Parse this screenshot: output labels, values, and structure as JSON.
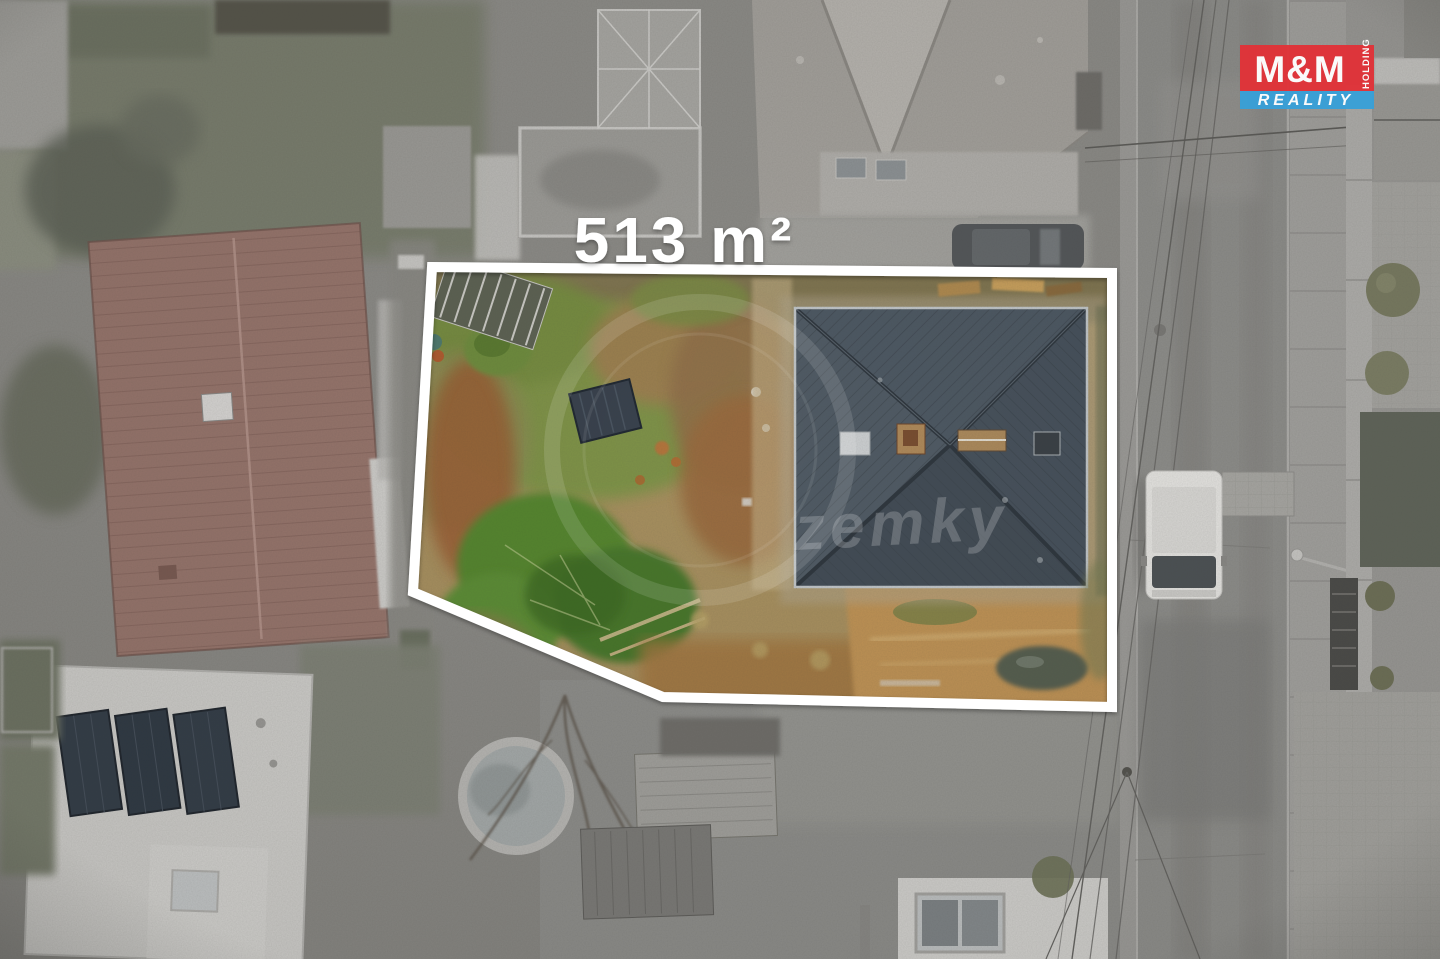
{
  "overlay": {
    "area_label": "513 m²",
    "outline_color": "#ffffff",
    "watermark_text": "zemky"
  },
  "logo": {
    "mm_text": "M&M",
    "holding_text": "HOLDING",
    "reality_text": "REALITY",
    "red": "#e13238",
    "blue": "#38a0d8"
  },
  "palette": {
    "base_gray": "#8b8a86",
    "road_gray": "#8f8f8c",
    "neighbor_roof_red": "#97756c",
    "neighbor_roof_gray": "#a5a29d",
    "subject_roof_dark": "#46505b",
    "plot_dirt_tan": "#a8905f",
    "plot_grass_green": "#7d9447",
    "tree_green": "#55862f",
    "dirt_orange": "#c09355",
    "van_white": "#e8e7e4"
  }
}
